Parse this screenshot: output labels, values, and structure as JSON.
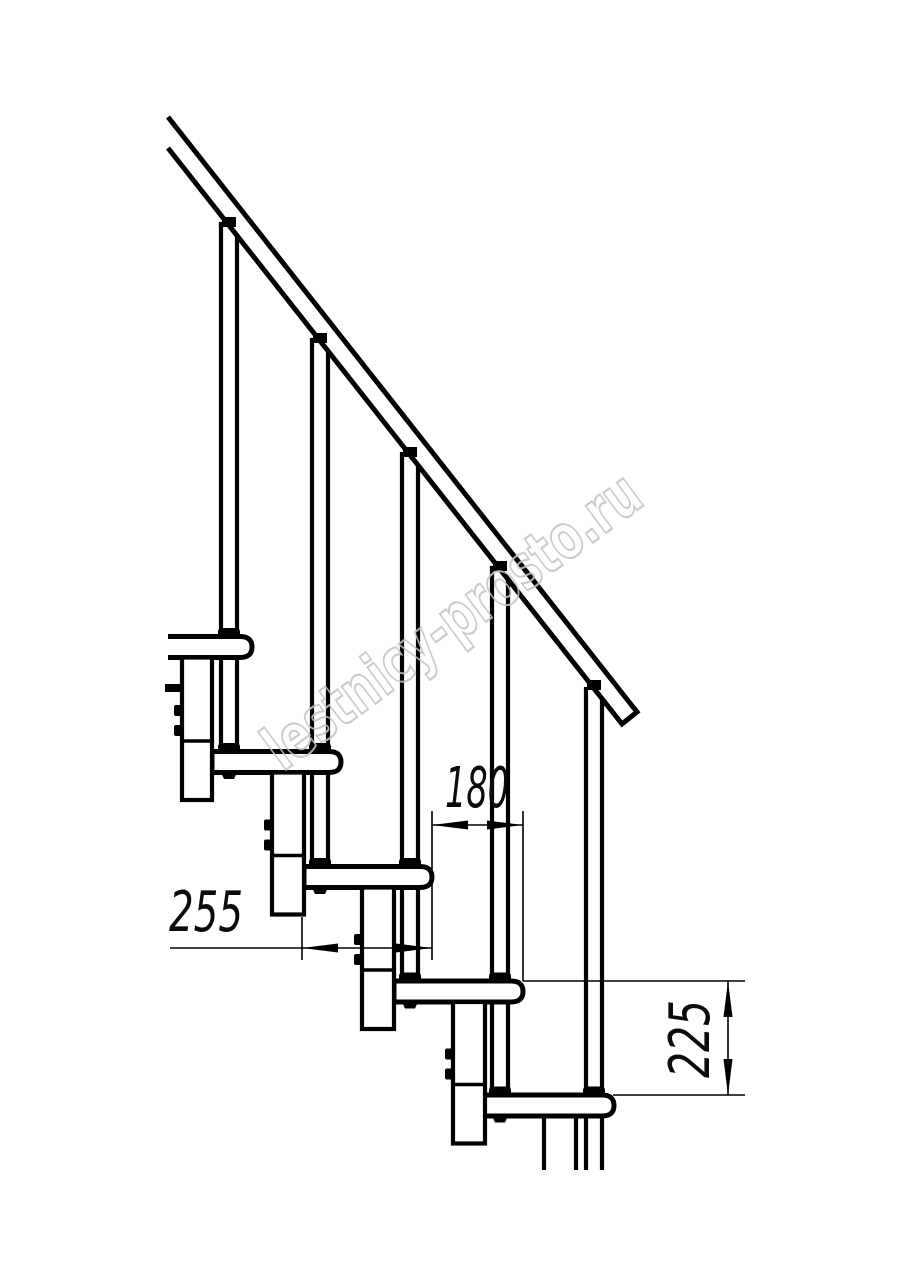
{
  "page": {
    "title": "Staircase technical drawing",
    "background": "#ffffff"
  },
  "drawing": {
    "subject": "modular staircase side elevation with railing",
    "line_color": "#000000",
    "dimensions": {
      "tread_run": {
        "value": "180",
        "orientation": "horizontal"
      },
      "tread_depth": {
        "value": "255",
        "orientation": "horizontal"
      },
      "step_rise": {
        "value": "225",
        "orientation": "vertical"
      }
    },
    "watermark": {
      "text": "lestnicy-prosto.ru",
      "color": "#c4c4c4"
    }
  }
}
